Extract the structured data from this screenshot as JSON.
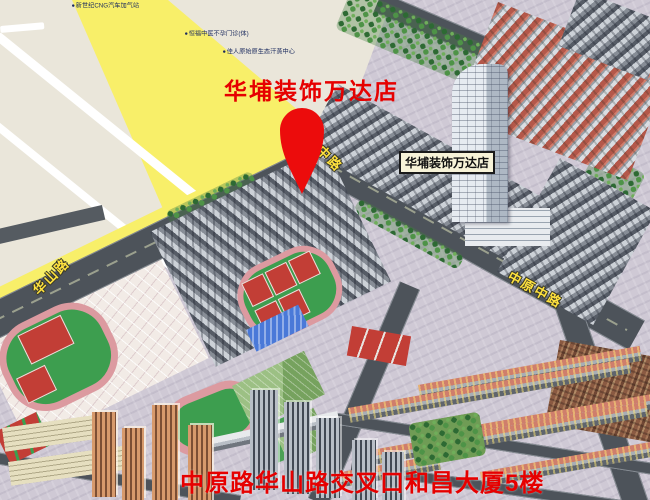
{
  "map": {
    "title": "华埔装饰万达店",
    "marker_label": "华埔装饰万达店",
    "caption": "中原路华山路交叉口和昌大厦5楼",
    "road_labels": {
      "left": "华山路",
      "center": "原中路",
      "right": "中原中路"
    },
    "poi_labels": [
      {
        "text": "新世纪CNG汽车加气站"
      },
      {
        "text": "恒福中医不孕门诊(体)"
      },
      {
        "text": "佳人原始原生态汗蒸中心"
      }
    ],
    "colors": {
      "title_red": "#e60000",
      "pin_red": "#ec0c0c",
      "road_label_yellow": "#ffe23e",
      "marker_label_bg": "#f7f3d8",
      "flat_map_yellow": "#f8ef69",
      "flat_map_beige": "#eae6da"
    }
  }
}
